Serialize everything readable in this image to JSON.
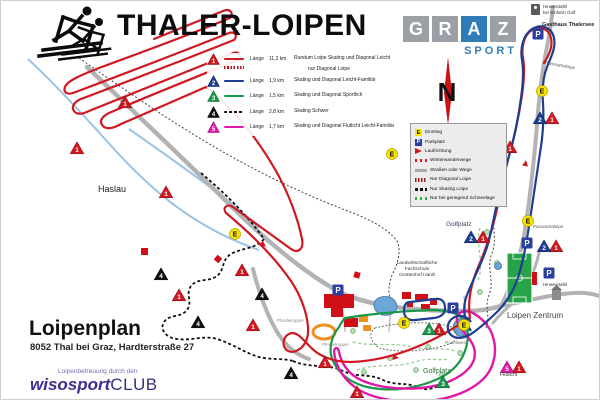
{
  "header": {
    "title": "THALER-LOIPEN",
    "graz": {
      "letters": [
        "G",
        "R",
        "A",
        "Z"
      ],
      "subtitle": "SPORT"
    },
    "top_right": {
      "hinweis1": "Hinweistafel",
      "hinweis2": "bei Einfahrt Golf",
      "gasthaus": "Gasthaus Thalersee"
    }
  },
  "compass": {
    "letter": "N"
  },
  "sym": {
    "E": "E",
    "P": "P",
    "n1": "1",
    "n2": "2",
    "n3": "3",
    "n4": "4",
    "n5": "5"
  },
  "trail_legend": {
    "length_label": "Länge",
    "rows": [
      {
        "num": "1",
        "length": "11,2 km",
        "desc": "Rundum Loipe Skating und Diagonal Leicht",
        "desc2": "nur Diagonal Loipe"
      },
      {
        "num": "2",
        "length": "1,9 km",
        "desc": "Skating und Diagonal  Leicht-Familiär"
      },
      {
        "num": "3",
        "length": "1,5 km",
        "desc": "Skating und Diagonal  Sportlich"
      },
      {
        "num": "4",
        "length": "2,8 km",
        "desc": "Skating Schwer"
      },
      {
        "num": "5",
        "length": "1,7 km",
        "desc": "Skating und Diagonal Flutlicht Leicht-Familiär"
      }
    ]
  },
  "symbol_legend": {
    "items": [
      {
        "label": "Einstieg"
      },
      {
        "label": "Parkplatz"
      },
      {
        "label": "Laufrichtung"
      },
      {
        "label": "Winterwanderwege"
      },
      {
        "label": "Straßen oder Wege"
      },
      {
        "label": "Nur Diagonal Loipe"
      },
      {
        "label": "Nur Skating Loipe"
      },
      {
        "label": "Nur bei genügend Schneelage"
      }
    ]
  },
  "map_labels": {
    "haslau": "Haslau",
    "golfplatz_nord": "Golfplatz",
    "golfplatz_sued": "Golfplatz",
    "loipen_zentrum": "Loipen Zentrum",
    "panoramaloipe_nord": "Panoramaloipe",
    "panoramaloipe_sued": "Panoramaloipe",
    "pferdekoppel_west": "Pferdekoppel",
    "pferdekoppel_ost": "Pferdekoppel",
    "fachschule_1": "Landwirtschaftliche",
    "fachschule_2": "Fachschule",
    "fachschule_3": "Grottenhof Hardt",
    "rodelwiese": "Rodelwiese",
    "flutlicht": "Flutlicht",
    "hinweistafel_ost": "Hinweistafel"
  },
  "footer": {
    "title": "Loipenplan",
    "address": "8052 Thal bei Graz, Hardterstraße 27",
    "club_caption": "Loipenbetreuung durch den",
    "club_name": "wisosport",
    "club_suffix": "CLUB"
  },
  "colors": {
    "trail1": "#d01820",
    "trail2": "#1d3d91",
    "trail3": "#18984a",
    "trail4": "#111111",
    "trail5": "#e018a8",
    "road": "#b3b3b3",
    "stream": "#9cc3e6",
    "accent_blue": "#2f7db8"
  }
}
